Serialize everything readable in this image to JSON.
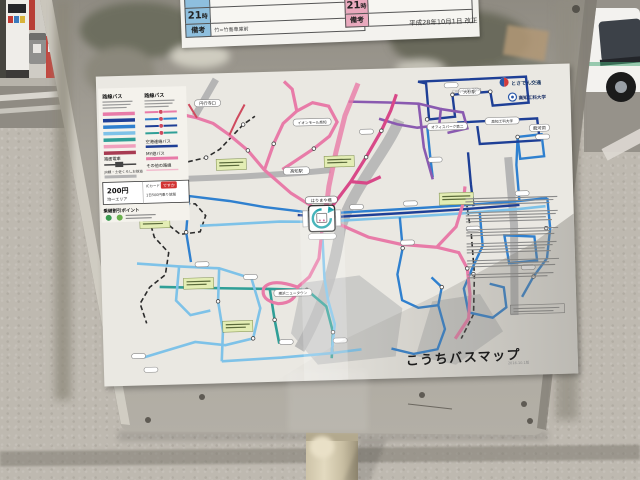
{
  "board": {
    "timetable": {
      "hour_unit": "時",
      "left": {
        "hour": "21",
        "remarks_label": "備考",
        "remarks_text": "竹=竹島車庫前"
      },
      "right": {
        "hour": "21",
        "remarks_label": "備考"
      },
      "revision": "平成28年10月1日 改正"
    },
    "map": {
      "title": "こうちバスマップ",
      "edition": "2016.10.1版",
      "copyright": "Copyright 2014",
      "operator": "とさでん交通",
      "university": "高知工科大学",
      "legend": {
        "route_bus_left": "路線バス",
        "route_bus_right": "路線バス",
        "airport_bus": "空港連絡バス",
        "my_yu_bus": "MY遊バス",
        "other_routes": "その他の路線",
        "tram": "路面電車",
        "jr_line": "JR線・土佐くろしお鉄道",
        "transfer": "乗継割引ポイント",
        "fare": {
          "amount": "200円",
          "area": "均一エリア",
          "ic_label": "ICカード",
          "ic_card": "ですか",
          "ic_note": "1日500円乗り放題"
        }
      },
      "stations": [
        {
          "name": "高知駅"
        },
        {
          "name": "はりまや橋"
        },
        {
          "name": "大杉駅"
        },
        {
          "name": "オフィスパーク第二"
        },
        {
          "name": "高知工科大学"
        },
        {
          "name": "龍河洞"
        },
        {
          "name": "イオンモール高知"
        },
        {
          "name": "横浜ニュータウン"
        },
        {
          "name": "円行寺口"
        }
      ],
      "colors": {
        "pink": "#e87ba8",
        "magenta": "#d84888",
        "navy": "#1e3f96",
        "blue": "#2f80cf",
        "light_blue": "#7ec2e8",
        "teal": "#2f9f97",
        "purple": "#8a5ab0",
        "red": "#cf4a5e",
        "rail_gray": "#b5b5b5",
        "header_blue": "#8ebfde",
        "header_pink": "#e9a9bd",
        "ic_red": "#d23333"
      }
    }
  }
}
